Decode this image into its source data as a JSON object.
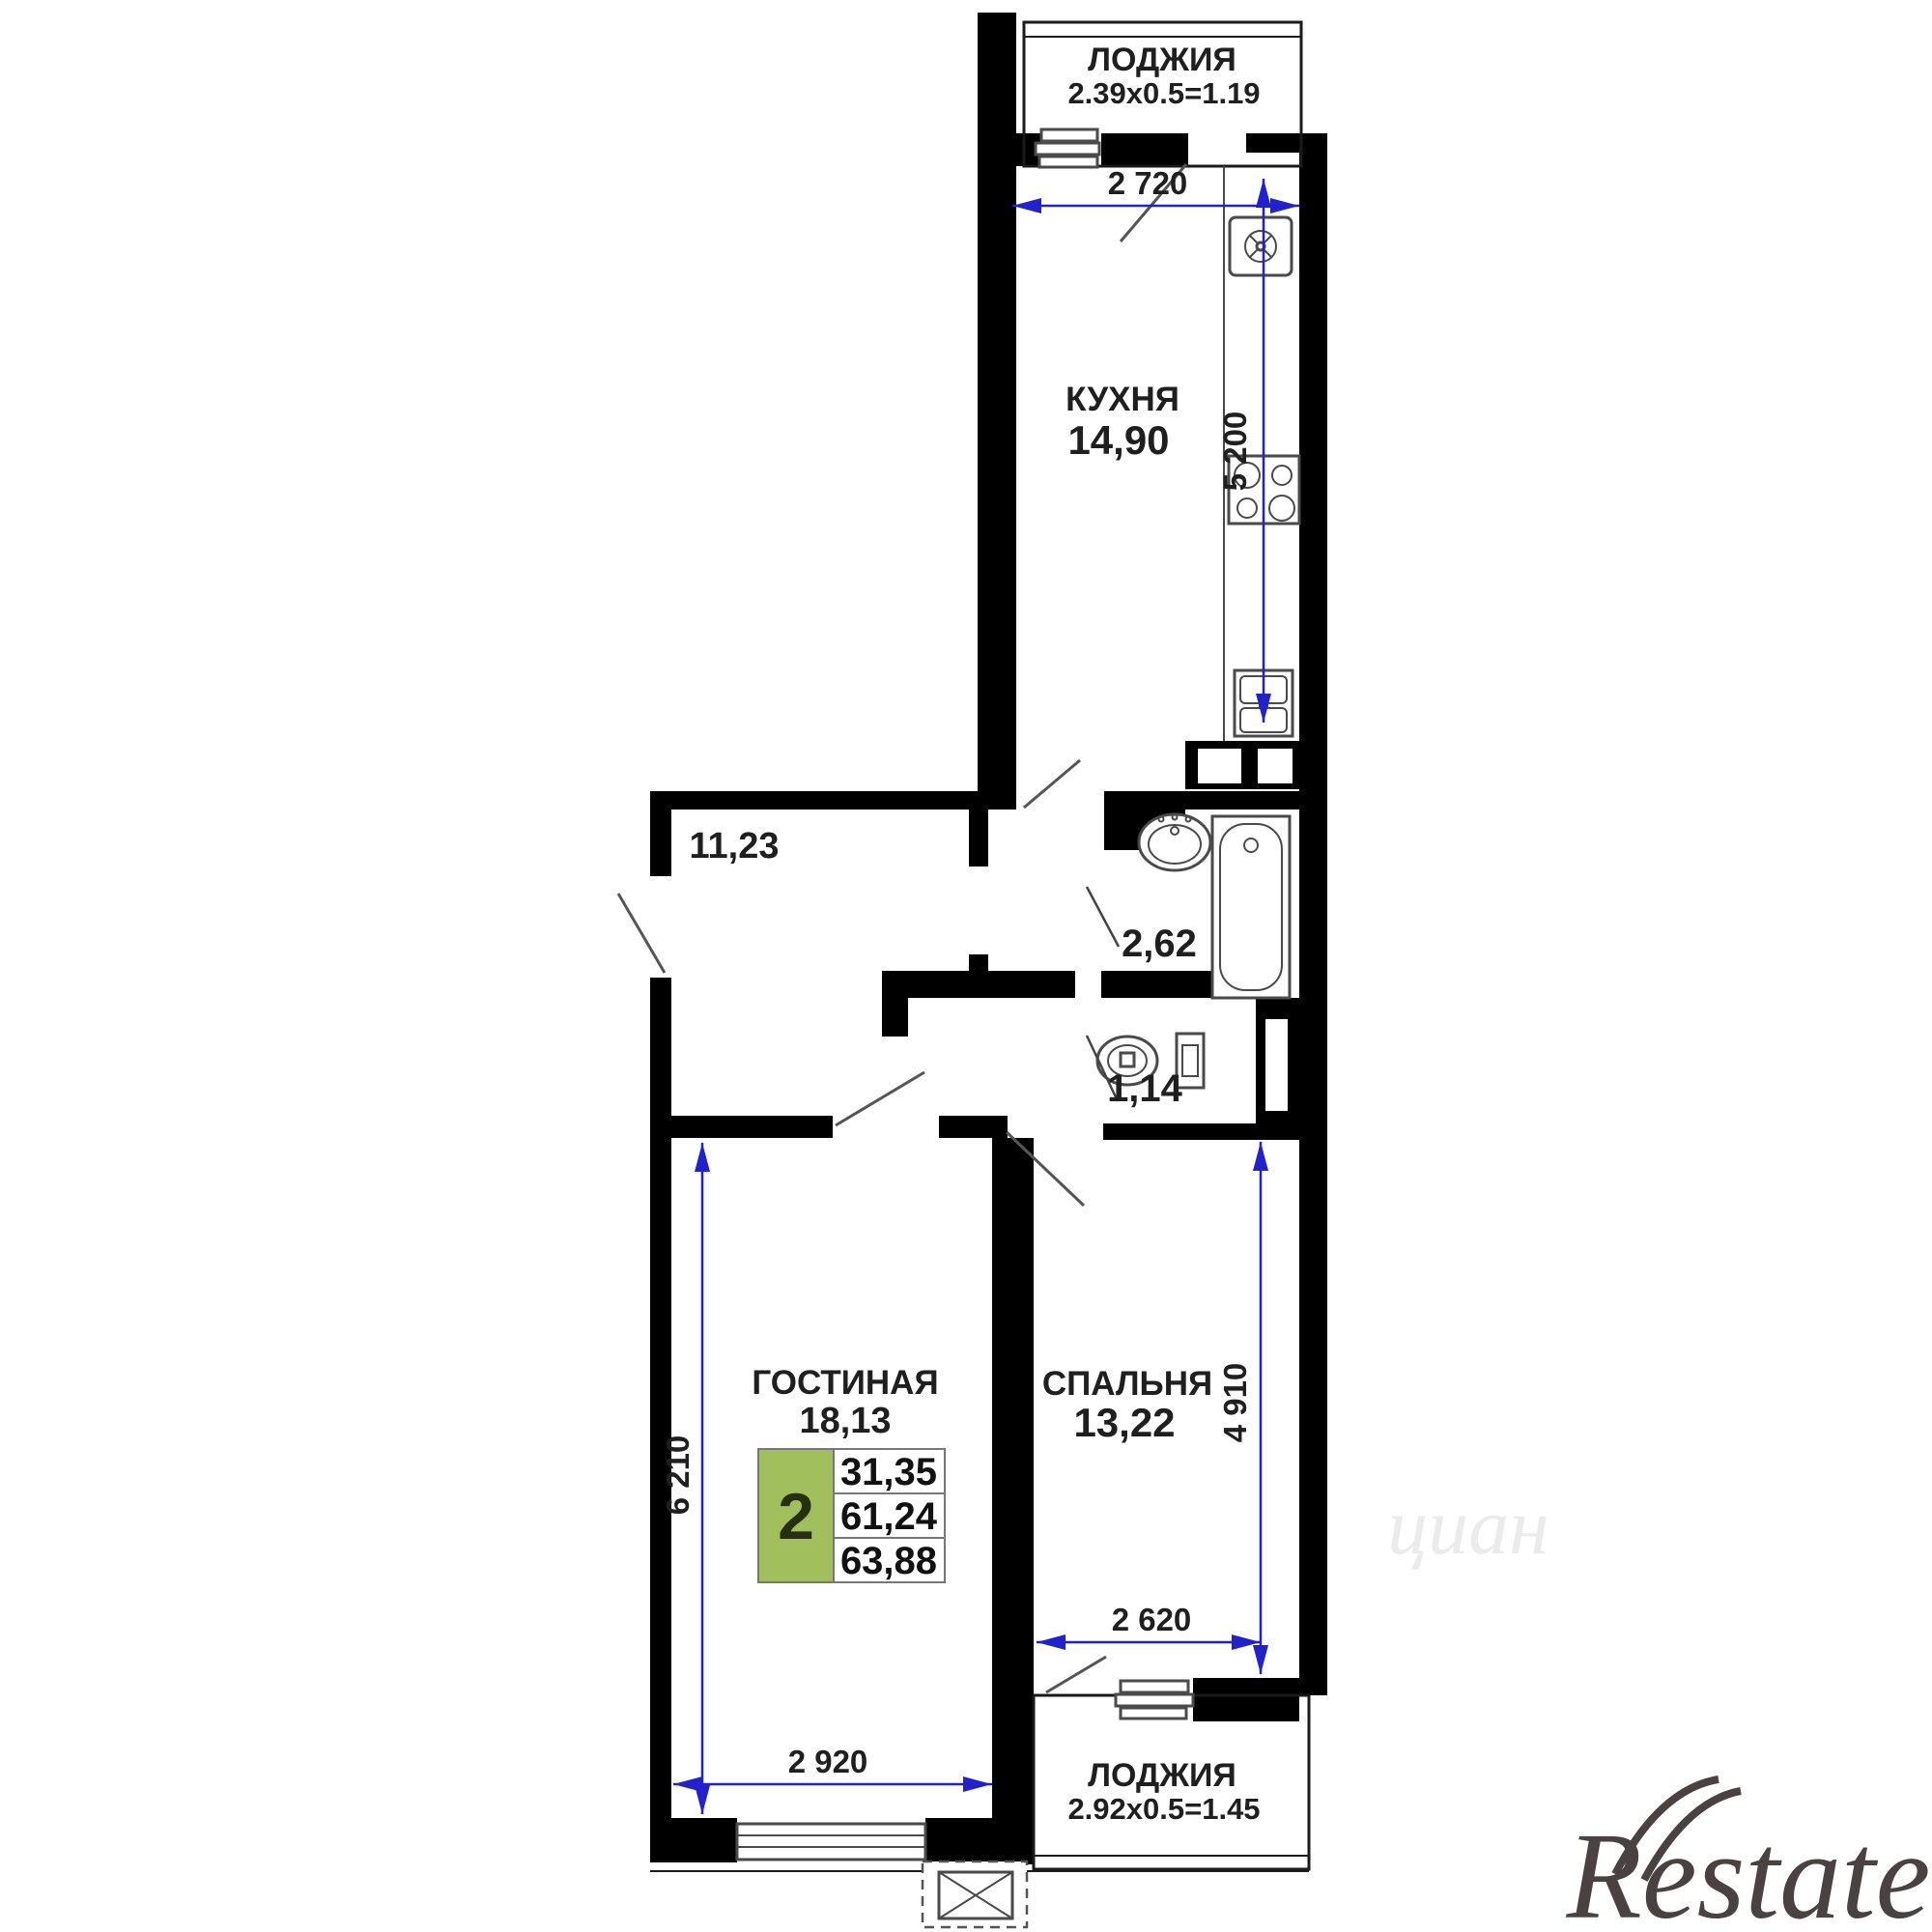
{
  "plan": {
    "rooms": {
      "loggia_top": {
        "name": "ЛОДЖИЯ",
        "dims": "2.39x0.5=1.19"
      },
      "kitchen": {
        "name": "КУХНЯ",
        "area": "14,90"
      },
      "hall": {
        "area": "11,23"
      },
      "bathroom": {
        "area": "2,62"
      },
      "wc": {
        "area": "1,14"
      },
      "living": {
        "name": "ГОСТИНАЯ",
        "area": "18,13"
      },
      "bedroom": {
        "name": "СПАЛЬНЯ",
        "area": "13,22"
      },
      "loggia_bottom": {
        "name": "ЛОДЖИЯ",
        "dims": "2.92x0.5=1.45"
      }
    },
    "dimensions": {
      "kitchen_width": "2 720",
      "kitchen_depth": "5 200",
      "living_depth": "6 210",
      "living_width": "2 920",
      "bedroom_depth": "4 910",
      "bedroom_width": "2 620"
    },
    "info_box": {
      "rooms_count": "2",
      "living_area": "31,35",
      "area": "61,24",
      "total_area": "63,88"
    },
    "watermark": "Restate",
    "watermark_faint": "циан"
  },
  "colors": {
    "wall": "#000000",
    "dim": "#2222cc",
    "accent_green": "#a2bf5e",
    "watermark": "#4a4241"
  }
}
